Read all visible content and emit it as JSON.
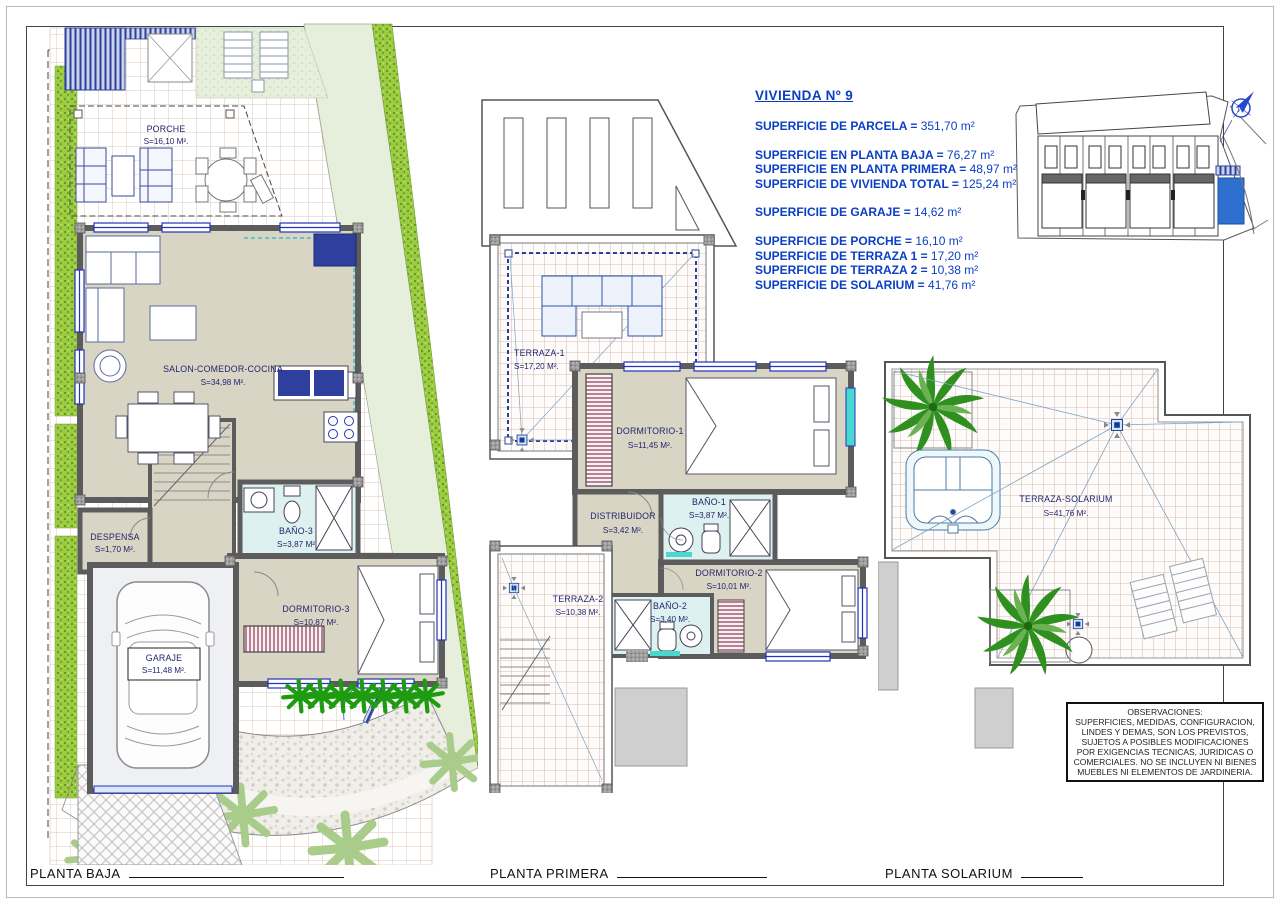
{
  "header": {
    "title": "VIVIENDA Nº 9",
    "groups": [
      {
        "lines": [
          {
            "label": "SUPERFICIE DE PARCELA = ",
            "value": "351,70 m²"
          }
        ]
      },
      {
        "lines": [
          {
            "label": "SUPERFICIE EN PLANTA BAJA = ",
            "value": "76,27 m²"
          },
          {
            "label": "SUPERFICIE EN PLANTA PRIMERA = ",
            "value": "48,97 m²"
          },
          {
            "label": "SUPERFICIE DE VIVIENDA TOTAL = ",
            "value": "125,24 m²"
          }
        ]
      },
      {
        "lines": [
          {
            "label": "SUPERFICIE DE GARAJE = ",
            "value": "14,62 m²"
          }
        ]
      },
      {
        "lines": [
          {
            "label": "SUPERFICIE DE PORCHE = ",
            "value": "16,10 m²"
          },
          {
            "label": "SUPERFICIE DE TERRAZA 1 = ",
            "value": "17,20 m²"
          },
          {
            "label": "SUPERFICIE DE TERRAZA 2 = ",
            "value": "10,38 m²"
          },
          {
            "label": "SUPERFICIE DE SOLARIUM = ",
            "value": "41,76 m²"
          }
        ]
      }
    ]
  },
  "site_map": {
    "north_label": "N"
  },
  "plans": {
    "planta_baja": {
      "rooms": {
        "porche": {
          "name": "PORCHE",
          "area": "S=16,10 M²."
        },
        "salon": {
          "name": "SALON-COMEDOR-COCINA",
          "area": "S=34,98 M²."
        },
        "despensa": {
          "name": "DESPENSA",
          "area": "S=1,70 M²."
        },
        "bano3": {
          "name": "BAÑO-3",
          "area": "S=3,87 M²"
        },
        "dormitorio3": {
          "name": "DORMITORIO-3",
          "area": "S=10,87 M²."
        },
        "garaje": {
          "name": "GARAJE",
          "area": "S=11,48 M²."
        }
      }
    },
    "planta_primera": {
      "rooms": {
        "terraza1": {
          "name": "TERRAZA-1",
          "area": "S=17,20 M²."
        },
        "dormitorio1": {
          "name": "DORMITORIO-1",
          "area": "S=11,45 M²."
        },
        "distribuidor": {
          "name": "DISTRIBUIDOR",
          "area": "S=3,42 M²."
        },
        "bano1": {
          "name": "BAÑO-1",
          "area": "S=3,87 M²."
        },
        "dormitorio2": {
          "name": "DORMITORIO-2",
          "area": "S=10,01 M²."
        },
        "terraza2": {
          "name": "TERRAZA-2",
          "area": "S=10,38 M²."
        },
        "bano2": {
          "name": "BAÑO-2",
          "area": "S=3,40 M²."
        }
      }
    },
    "planta_solarium": {
      "rooms": {
        "terraza_solarium": {
          "name": "TERRAZA-SOLARIUM",
          "area": "S=41,76 M²."
        }
      }
    }
  },
  "observaciones": {
    "title": "OBSERVACIONES:",
    "body": "SUPERFICIES, MEDIDAS, CONFIGURACION, LINDES Y DEMAS, SON LOS PREVISTOS, SUJETOS A POSIBLES MODIFICACIONES POR EXIGENCIAS TECNICAS, JURIDICAS O COMERCIALES. NO SE INCLUYEN NI BIENES MUEBLES NI ELEMENTOS DE JARDINERIA."
  },
  "footer": {
    "labels": [
      {
        "text": "PLANTA BAJA"
      },
      {
        "text": "PLANTA PRIMERA"
      },
      {
        "text": "PLANTA SOLARIUM"
      }
    ]
  },
  "colors": {
    "accent_blue": "#0a3fc4",
    "wall_gray": "#5c5c5c",
    "floor_beige": "#d9d5c5",
    "bath_cyan": "#def1f1",
    "grass_green": "#9ccb3f",
    "pale_green": "#e6efdb",
    "tile_line": "#cfa99a",
    "palm_green": "#2f8f1f",
    "closet_red": "#8b2143",
    "plot_blue": "#2e6fd0"
  }
}
